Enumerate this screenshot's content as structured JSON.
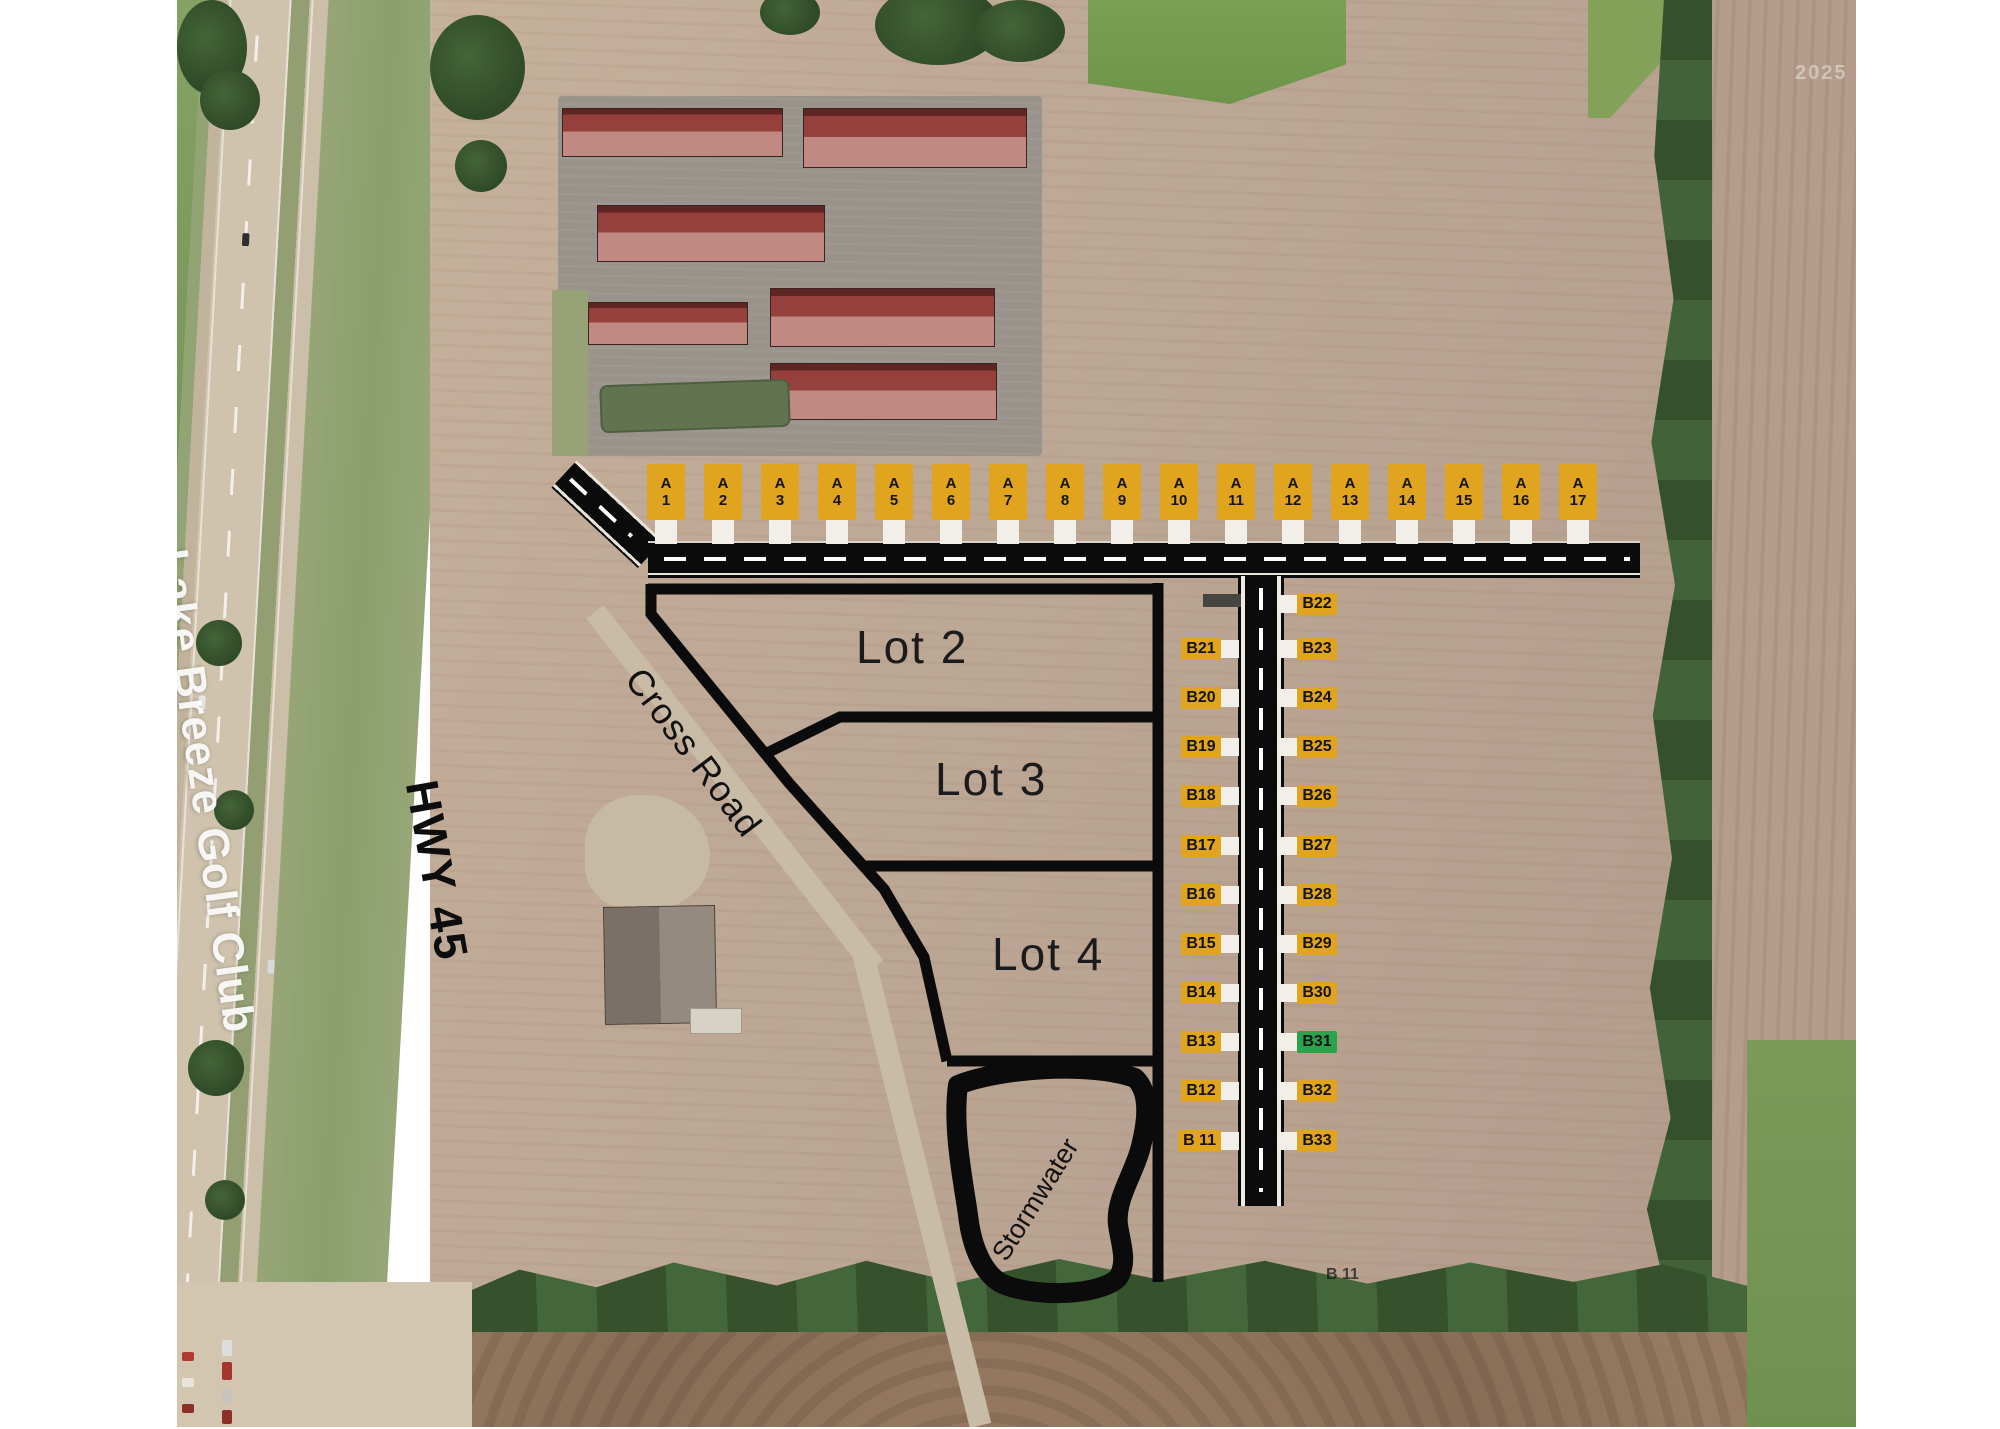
{
  "labels": {
    "golf_club": "Lake Breeze Golf Club",
    "highway": "HWY 45",
    "cross_road": "Cross Road",
    "stormwater": "Stormwater",
    "lot2": "Lot 2",
    "lot3": "Lot 3",
    "lot4": "Lot 4",
    "ghost_b11": "B 11",
    "watermark": "2025"
  },
  "colors": {
    "marker_yellow": "#E0A41E",
    "marker_green": "#2BA34B",
    "marker_text": "#141414",
    "road_black": "#0B0B0B",
    "stub_white": "#F2EFE8",
    "boundary_black": "#0B0B0B"
  },
  "markers": {
    "a_row_prefix": "A",
    "a_row": [
      {
        "num": "1",
        "x": 666
      },
      {
        "num": "2",
        "x": 723
      },
      {
        "num": "3",
        "x": 780
      },
      {
        "num": "4",
        "x": 837
      },
      {
        "num": "5",
        "x": 894
      },
      {
        "num": "6",
        "x": 951
      },
      {
        "num": "7",
        "x": 1008
      },
      {
        "num": "8",
        "x": 1065
      },
      {
        "num": "9",
        "x": 1122
      },
      {
        "num": "10",
        "x": 1179
      },
      {
        "num": "11",
        "x": 1236
      },
      {
        "num": "12",
        "x": 1293
      },
      {
        "num": "13",
        "x": 1350
      },
      {
        "num": "14",
        "x": 1407
      },
      {
        "num": "15",
        "x": 1464
      },
      {
        "num": "16",
        "x": 1521
      },
      {
        "num": "17",
        "x": 1578
      }
    ],
    "b_left": [
      {
        "label": "B21",
        "y": 649
      },
      {
        "label": "B20",
        "y": 698
      },
      {
        "label": "B19",
        "y": 747
      },
      {
        "label": "B18",
        "y": 796
      },
      {
        "label": "B17",
        "y": 846
      },
      {
        "label": "B16",
        "y": 895
      },
      {
        "label": "B15",
        "y": 944
      },
      {
        "label": "B14",
        "y": 993
      },
      {
        "label": "B13",
        "y": 1042
      },
      {
        "label": "B12",
        "y": 1091
      },
      {
        "label": "B 11",
        "y": 1141
      }
    ],
    "b_right": [
      {
        "label": "B22",
        "y": 604
      },
      {
        "label": "B23",
        "y": 649
      },
      {
        "label": "B24",
        "y": 698
      },
      {
        "label": "B25",
        "y": 747
      },
      {
        "label": "B26",
        "y": 796
      },
      {
        "label": "B27",
        "y": 846
      },
      {
        "label": "B28",
        "y": 895
      },
      {
        "label": "B29",
        "y": 944
      },
      {
        "label": "B30",
        "y": 993
      },
      {
        "label": "B31",
        "y": 1042,
        "highlight": true
      },
      {
        "label": "B32",
        "y": 1091
      },
      {
        "label": "B33",
        "y": 1141
      }
    ]
  }
}
